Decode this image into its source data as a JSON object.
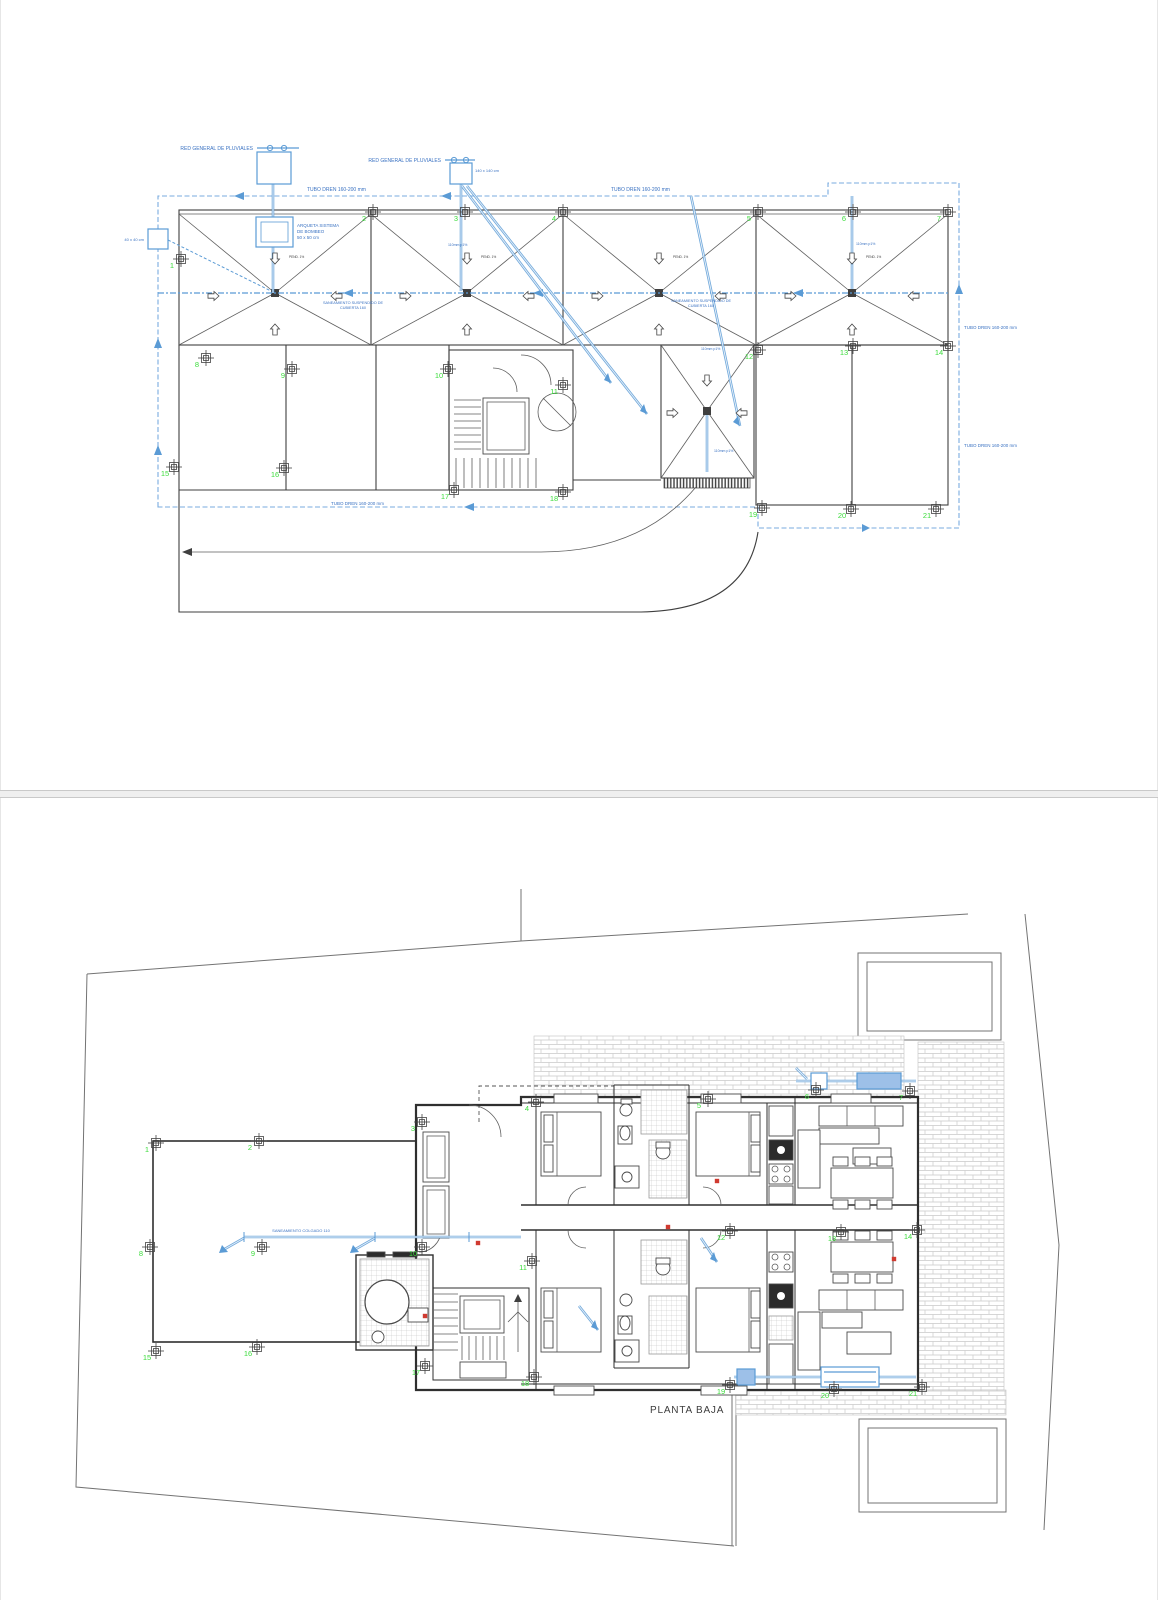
{
  "roof_plan": {
    "labels": {
      "red_general_left": "RED GENERAL DE PLUVIALES",
      "red_general_right": "RED GENERAL DE PLUVIALES",
      "tubo_dren_top_left": "TUBO DREN 160-200 mm",
      "tubo_dren_top_right": "TUBO DREN 160-200 mm",
      "tubo_dren_right_upper": "TUBO DREN 160-200 mm",
      "tubo_dren_right_lower": "TUBO DREN 160-200 mm",
      "tubo_dren_bottom": "TUBO DREN 160-200 mm",
      "arqueta_line1": "ARQUETA SISTEMA",
      "arqueta_line2": "DE BOMBEO",
      "arqueta_line3": "50 x 50 cm",
      "arqueta_left": "40 x 40 cm",
      "arqueta_mid": "140 x 140 cm",
      "saneamiento_center_1": "SANEAMIENTO SUSPENDIDO DE",
      "saneamiento_center_2": "CUBIERTA 160",
      "saneamiento_left_1": "SANEAMIENTO SUSPENDIDO DE",
      "saneamiento_left_2": "CUBIERTA 160",
      "pend": "PEND. 1%",
      "riser": "110mm p1%"
    },
    "grid_numbers": [
      {
        "n": "1",
        "x": 171,
        "y": 268
      },
      {
        "n": "2",
        "x": 363,
        "y": 221
      },
      {
        "n": "3",
        "x": 455,
        "y": 221
      },
      {
        "n": "4",
        "x": 553,
        "y": 221
      },
      {
        "n": "5",
        "x": 748,
        "y": 221
      },
      {
        "n": "6",
        "x": 843,
        "y": 221
      },
      {
        "n": "7",
        "x": 938,
        "y": 221
      },
      {
        "n": "8",
        "x": 196,
        "y": 367
      },
      {
        "n": "9",
        "x": 282,
        "y": 378
      },
      {
        "n": "10",
        "x": 438,
        "y": 378
      },
      {
        "n": "11",
        "x": 553,
        "y": 394
      },
      {
        "n": "12",
        "x": 748,
        "y": 359
      },
      {
        "n": "13",
        "x": 843,
        "y": 355
      },
      {
        "n": "14",
        "x": 938,
        "y": 355
      },
      {
        "n": "15",
        "x": 164,
        "y": 476
      },
      {
        "n": "16",
        "x": 274,
        "y": 477
      },
      {
        "n": "17",
        "x": 444,
        "y": 499
      },
      {
        "n": "18",
        "x": 553,
        "y": 501
      },
      {
        "n": "19",
        "x": 752,
        "y": 517
      },
      {
        "n": "20",
        "x": 841,
        "y": 518
      },
      {
        "n": "21",
        "x": 926,
        "y": 518
      }
    ]
  },
  "floor_plan": {
    "title": "PLANTA BAJA",
    "labels": {
      "saneamiento_colgado": "SANEAMIENTO COLGADO 110"
    },
    "grid_numbers": [
      {
        "n": "1",
        "x": 146,
        "y": 1152
      },
      {
        "n": "2",
        "x": 249,
        "y": 1150
      },
      {
        "n": "3",
        "x": 412,
        "y": 1131
      },
      {
        "n": "4",
        "x": 526,
        "y": 1111
      },
      {
        "n": "5",
        "x": 698,
        "y": 1108
      },
      {
        "n": "6",
        "x": 806,
        "y": 1099
      },
      {
        "n": "7",
        "x": 900,
        "y": 1100
      },
      {
        "n": "8",
        "x": 140,
        "y": 1256
      },
      {
        "n": "9",
        "x": 252,
        "y": 1256
      },
      {
        "n": "10",
        "x": 412,
        "y": 1256
      },
      {
        "n": "11",
        "x": 522,
        "y": 1270
      },
      {
        "n": "12",
        "x": 720,
        "y": 1240
      },
      {
        "n": "13",
        "x": 831,
        "y": 1241
      },
      {
        "n": "14",
        "x": 907,
        "y": 1239
      },
      {
        "n": "15",
        "x": 146,
        "y": 1360
      },
      {
        "n": "16",
        "x": 247,
        "y": 1356
      },
      {
        "n": "17",
        "x": 415,
        "y": 1375
      },
      {
        "n": "18",
        "x": 524,
        "y": 1386
      },
      {
        "n": "19",
        "x": 720,
        "y": 1394
      },
      {
        "n": "20",
        "x": 824,
        "y": 1398
      },
      {
        "n": "21",
        "x": 912,
        "y": 1396
      }
    ]
  }
}
